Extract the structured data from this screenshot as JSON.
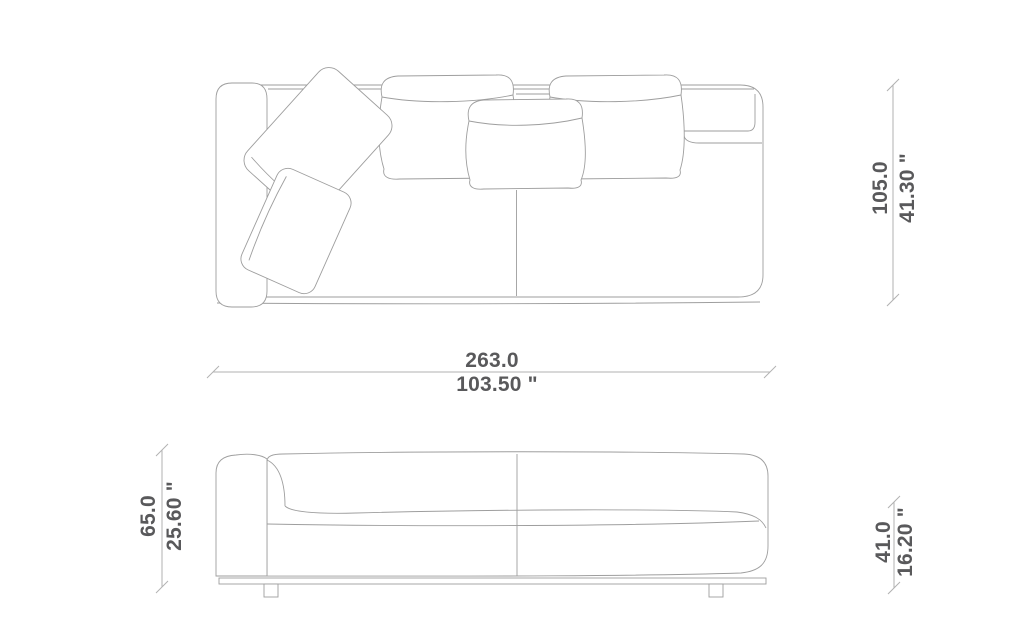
{
  "drawing": {
    "type": "furniture-dimension-drawing",
    "subject": "sofa",
    "views": [
      "top-plan-view",
      "front-elevation-view"
    ]
  },
  "dimensions": {
    "top_view_width": {
      "metric": "263.0",
      "imperial": "103.50 \""
    },
    "top_view_depth": {
      "metric": "105.0",
      "imperial": "41.30 \""
    },
    "front_view_height": {
      "metric": "65.0",
      "imperial": "25.60 \""
    },
    "front_view_seat_height": {
      "metric": "41.0",
      "imperial": "16.20 \""
    }
  },
  "colors": {
    "background": "#ffffff",
    "outline": "#9e9e9e",
    "dimension_line": "#b2b2b2",
    "dimension_text": "#59595b"
  }
}
